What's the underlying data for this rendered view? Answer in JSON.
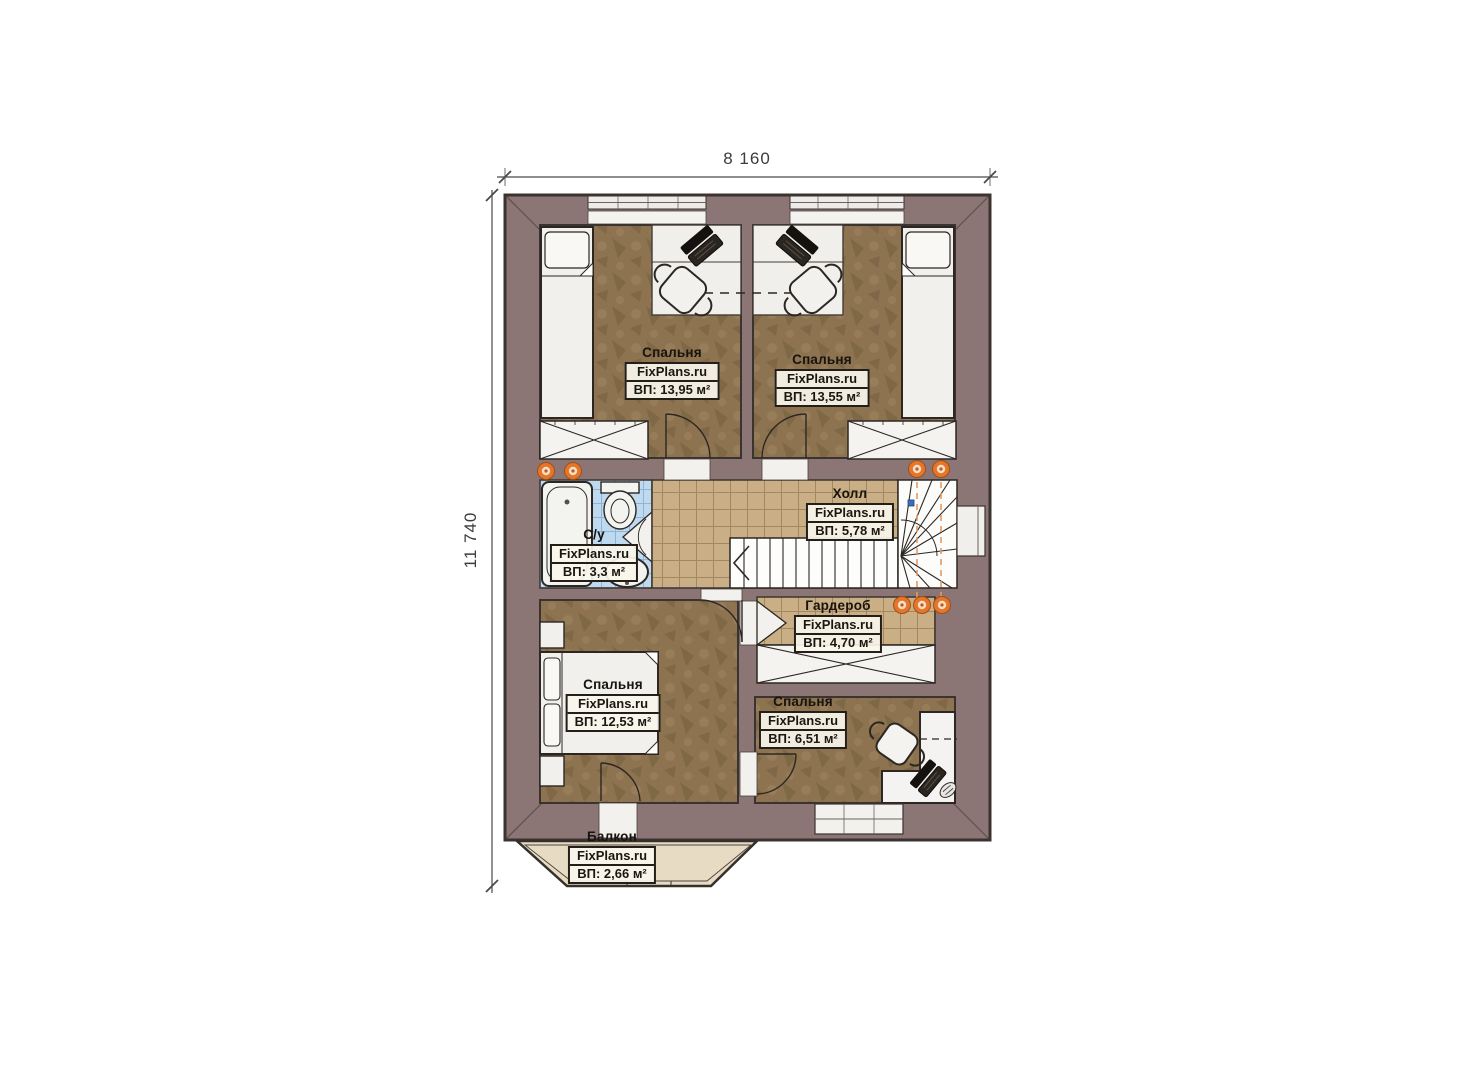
{
  "dimensions": {
    "width": "8 160",
    "height": "11 740"
  },
  "watermark": "FixPlans.ru",
  "rooms": [
    {
      "id": "bedroom-top-left",
      "name": "Спальня",
      "area": "ВП: 13,95 м²"
    },
    {
      "id": "bedroom-top-right",
      "name": "Спальня",
      "area": "ВП: 13,55 м²"
    },
    {
      "id": "bathroom",
      "name": "С/у",
      "area": "ВП: 3,3 м²"
    },
    {
      "id": "hall",
      "name": "Холл",
      "area": "ВП: 5,78 м²"
    },
    {
      "id": "wardrobe",
      "name": "Гардероб",
      "area": "ВП: 4,70 м²"
    },
    {
      "id": "bedroom-bottom-left",
      "name": "Спальня",
      "area": "ВП: 12,53 м²"
    },
    {
      "id": "bedroom-bottom-right",
      "name": "Спальня",
      "area": "ВП: 6,51 м²"
    },
    {
      "id": "balcony",
      "name": "Балкон",
      "area": "ВП: 2,66 м²"
    }
  ],
  "colors": {
    "wall": "#8b7675",
    "outline": "#3b332f",
    "floor_wood": "#8d7350",
    "tile_tan": "#c9ae86",
    "tile_blue": "#bfd9ef",
    "balcony_floor": "#e7dcc3",
    "lamp": "#e4762c",
    "furniture": "#f2f1ee"
  }
}
